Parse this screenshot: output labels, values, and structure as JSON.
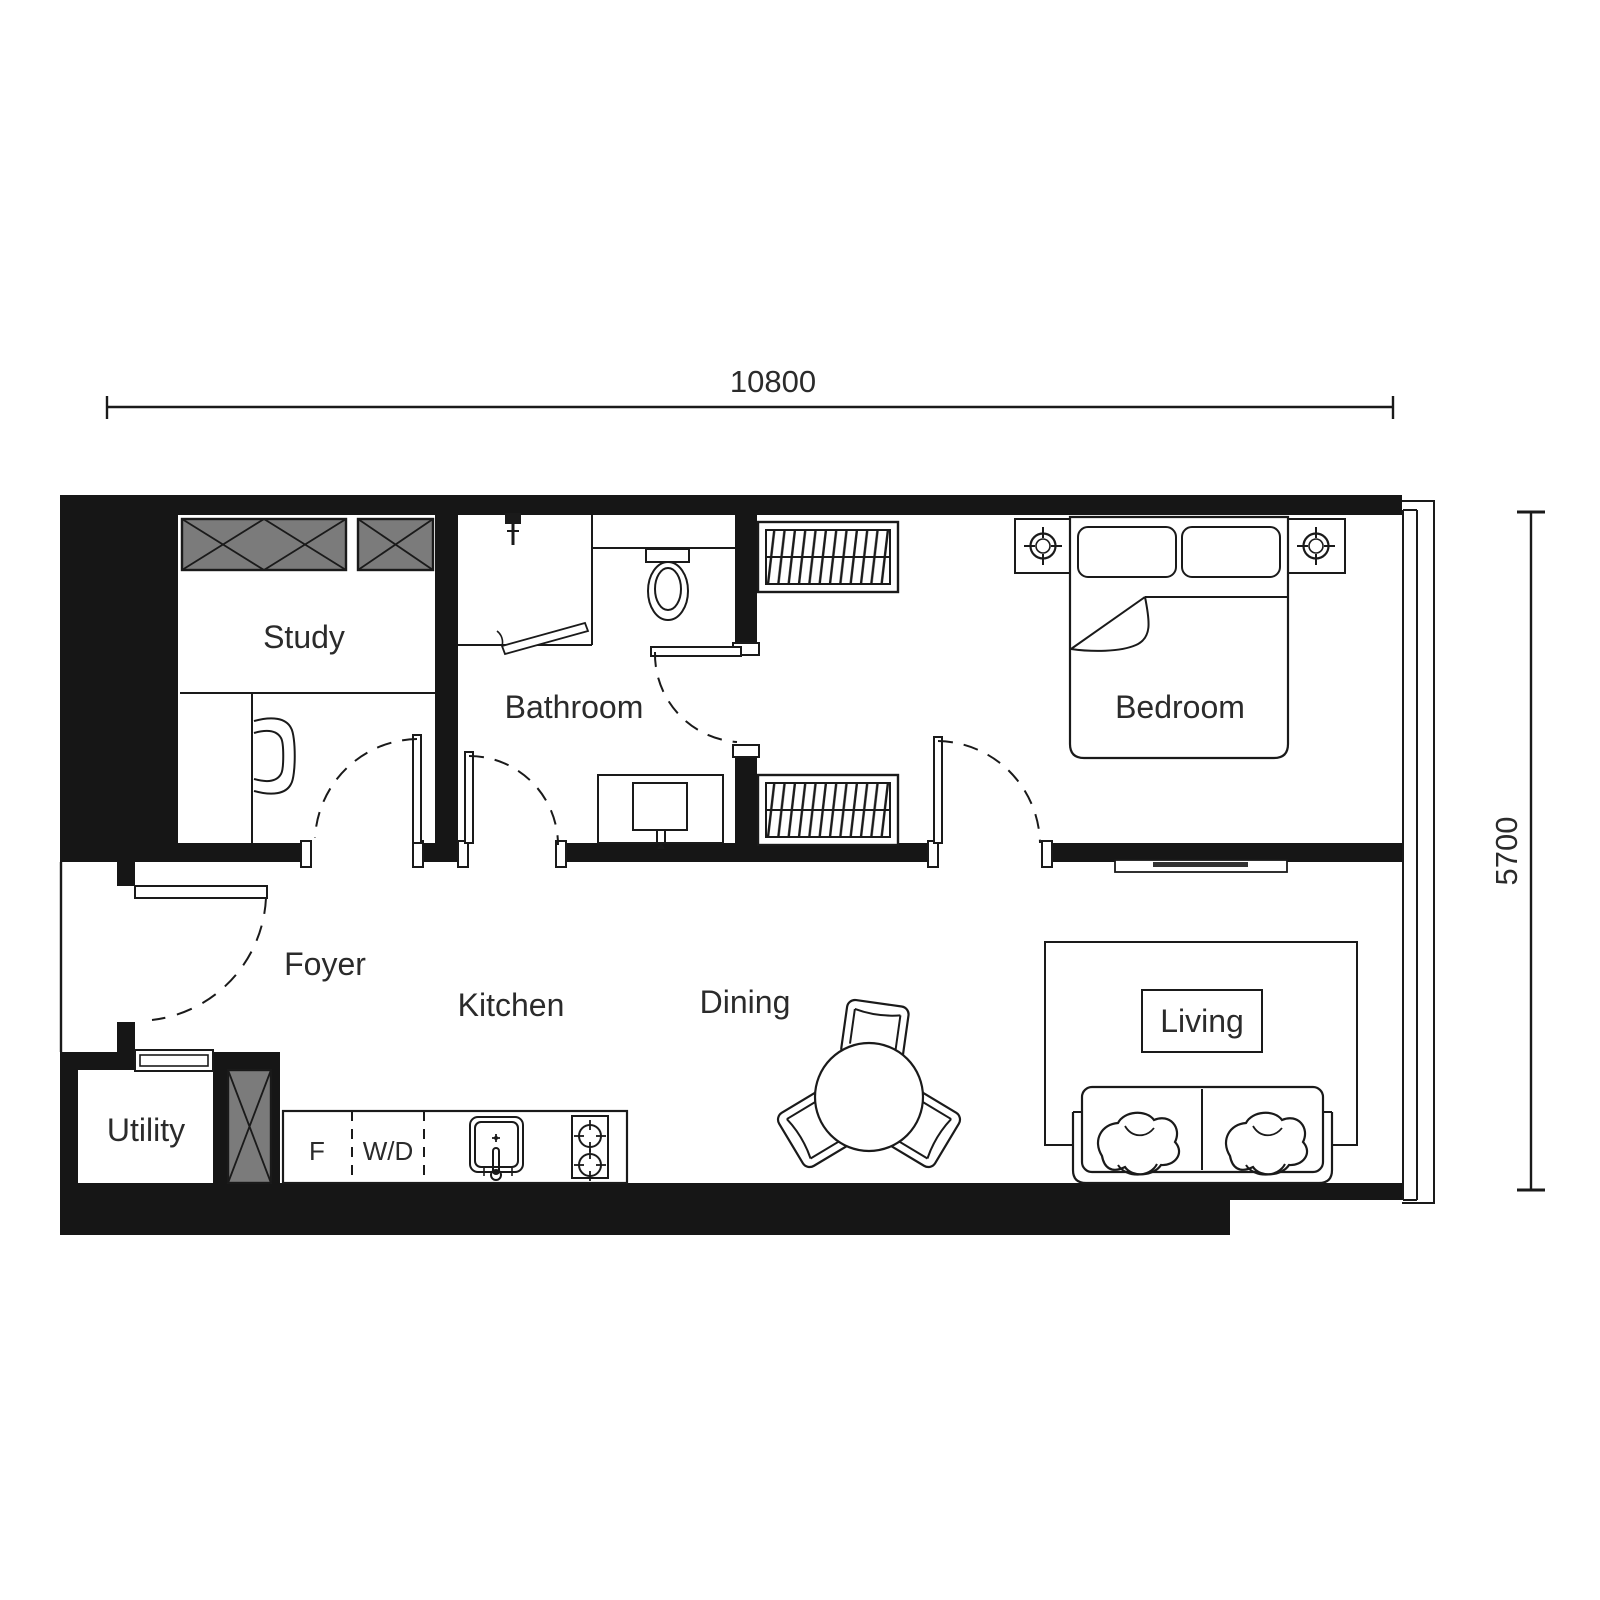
{
  "plan": {
    "dimension_width_label": "10800",
    "dimension_height_label": "5700",
    "rooms": {
      "study": "Study",
      "bathroom": "Bathroom",
      "bedroom": "Bedroom",
      "foyer": "Foyer",
      "kitchen": "Kitchen",
      "dining": "Dining",
      "living": "Living",
      "utility": "Utility"
    },
    "appliances": {
      "fridge": "F",
      "washer_dryer": "W/D"
    },
    "colors": {
      "wall": "#161616",
      "line": "#1a1a1a",
      "cabinet_gray": "#7b7b7b",
      "text": "#2b2b2b",
      "background": "#ffffff"
    }
  }
}
